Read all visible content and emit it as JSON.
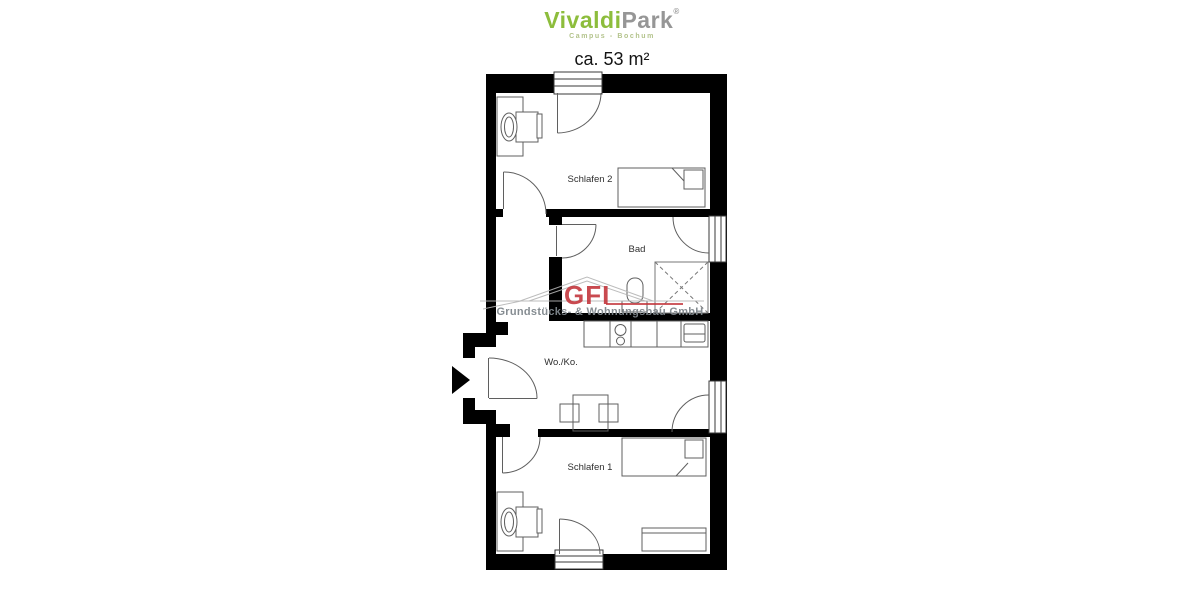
{
  "header": {
    "brand_green": "Vivaldi",
    "brand_gray": "Park",
    "registered": "®",
    "subtitle": "Campus - Bochum",
    "area_label": "ca. 53 m²",
    "brand_green_color": "#8dbd3c",
    "brand_gray_color": "#969696"
  },
  "floorplan": {
    "rooms": [
      {
        "id": "schlafen2",
        "label": "Schlafen 2"
      },
      {
        "id": "bad",
        "label": "Bad"
      },
      {
        "id": "woko",
        "label": "Wo./Ko."
      },
      {
        "id": "schlafen1",
        "label": "Schlafen 1"
      }
    ],
    "wall_color": "#000000",
    "furniture_line_color": "#5f5f5f"
  },
  "watermark": {
    "logo": "GFI",
    "company": "Grundstücks- & Wohnungsbau GmbH",
    "logo_color": "#c23238",
    "company_color": "#7f868c"
  }
}
